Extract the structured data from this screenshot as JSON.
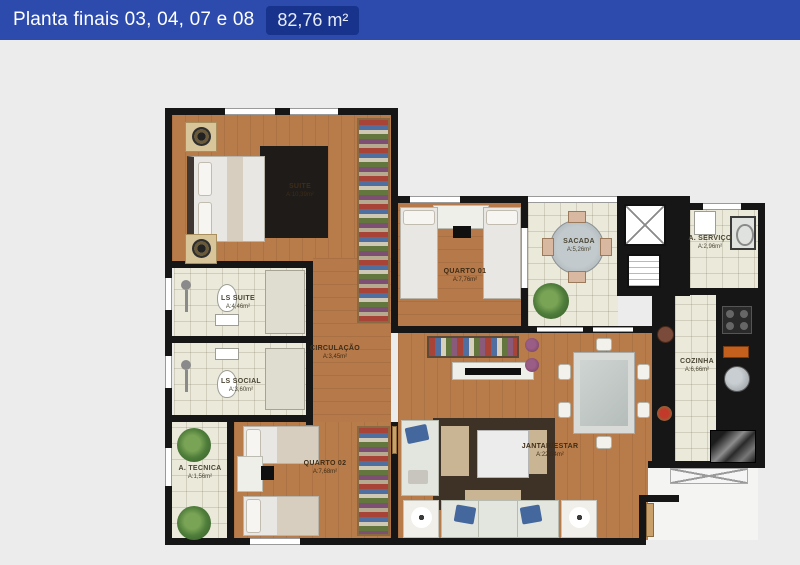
{
  "header": {
    "title": "Planta finais 03, 04, 07 e 08",
    "area_badge": "82,76 m²"
  },
  "floorplan": {
    "rooms": [
      {
        "name": "SUITE",
        "area": "A:10,39m²"
      },
      {
        "name": "QUARTO 01",
        "area": "A:7,76m²"
      },
      {
        "name": "SACADA",
        "area": "A:5,26m²"
      },
      {
        "name": "A. SERVIÇO",
        "area": "A:2,96m²"
      },
      {
        "name": "COZINHA",
        "area": "A:6,66m²"
      },
      {
        "name": "LS SUITE",
        "area": "A:4,46m²"
      },
      {
        "name": "LS SOCIAL",
        "area": "A:3,60m²"
      },
      {
        "name": "CIRCULAÇÃO",
        "area": "A:3,45m²"
      },
      {
        "name": "A. TECNICA",
        "area": "A:1,56m²"
      },
      {
        "name": "QUARTO 02",
        "area": "A:7,68m²"
      },
      {
        "name": "JANTAR/ESTAR",
        "area": "A:22,54m²"
      }
    ],
    "colors": {
      "header_blue": "#2c4bad",
      "badge_blue": "#17338b",
      "wall_black": "#161616",
      "wood_floor": "#b87c4a",
      "tile_floor": "#ebe9da",
      "background": "#ececec"
    }
  }
}
